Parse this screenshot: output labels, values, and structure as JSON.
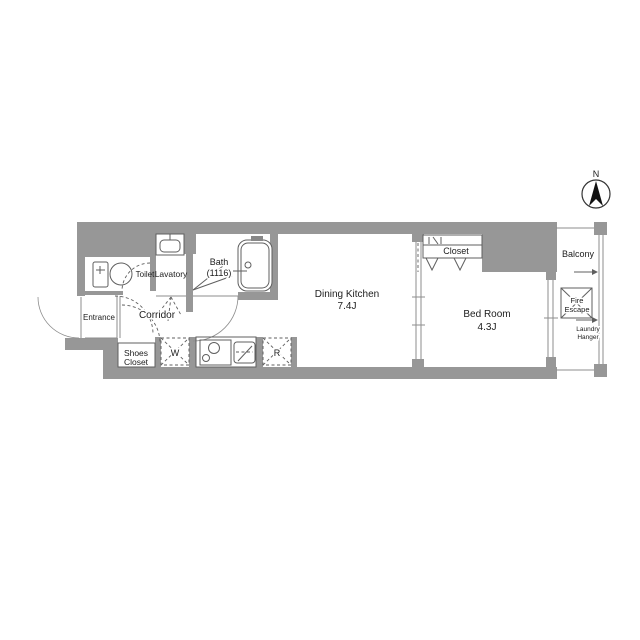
{
  "title": "Apartment floor plan",
  "colors": {
    "wall": "#979797",
    "line": "#8d8d8d",
    "fixline": "#5f5f5f",
    "text": "#1c1c1c"
  },
  "compass": {
    "north_label": "N"
  },
  "rooms": {
    "toilet": "Toilet",
    "lavatory": "Lavatory",
    "bath_line1": "Bath",
    "bath_line2": "(1116)",
    "entrance": "Entrance",
    "corridor": "Corridor",
    "shoes_closet_line1": "Shoes",
    "shoes_closet_line2": "Closet",
    "dining_kitchen_line1": "Dining Kitchen",
    "dining_kitchen_line2": "7.4J",
    "closet": "Closet",
    "bedroom_line1": "Bed Room",
    "bedroom_line2": "4.3J",
    "balcony": "Balcony",
    "fire_escape_line1": "Fire",
    "fire_escape_line2": "Escape",
    "laundry_hanger_line1": "Laundry",
    "laundry_hanger_line2": "Hanger",
    "washer": "W",
    "refrigerator": "R"
  }
}
